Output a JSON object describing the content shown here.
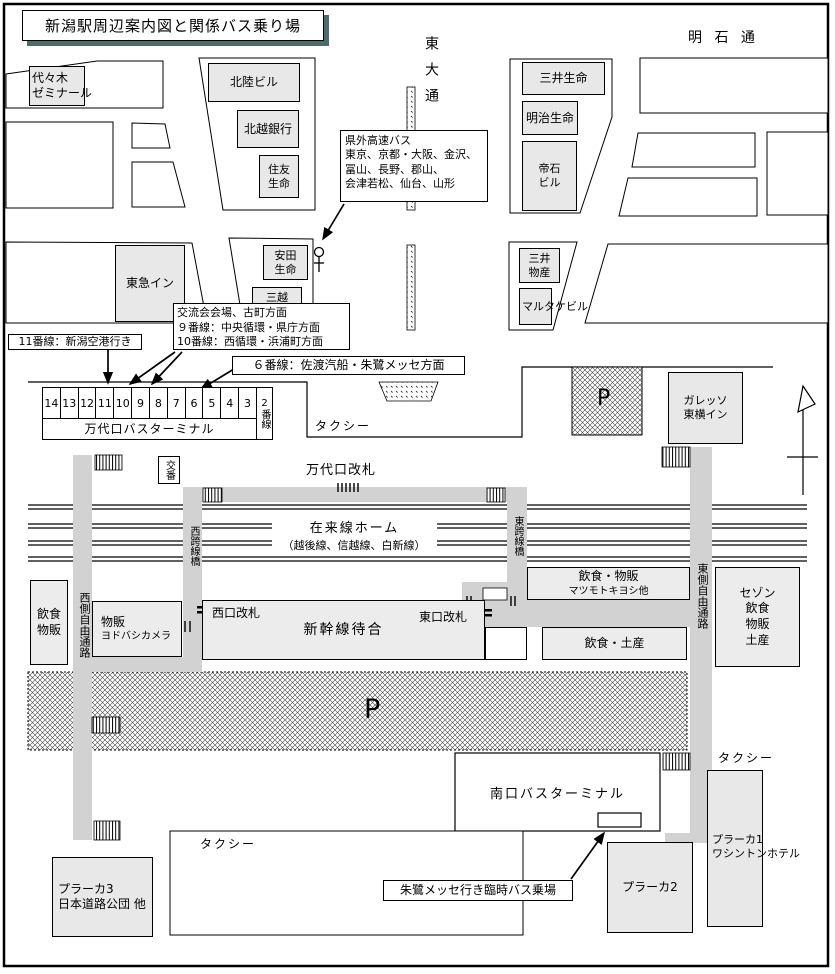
{
  "title": "新潟駅周辺案内図と関係バス乗り場",
  "streets": {
    "higashi_odori": "東大通",
    "akashi_dori": "明 石 通"
  },
  "callouts": {
    "kengai_kosoku": "県外高速バス\n東京、京都・大阪、金沢、\n冨山、長野、郡山、\n会津若松、仙台、山形",
    "kouryukai": "交流会会場、古町方面\n９番線：中央循環・県庁方面\n10番線：西循環・浜浦町方面",
    "line11": "11番線：新潟空港行き",
    "line6": "６番線：佐渡汽船・朱鷺メッセ方面",
    "toki_messe": "朱鷺メッセ行き臨時バス乗場"
  },
  "bus_terminal": {
    "name": "万代口バスターミナル",
    "stalls": [
      "14",
      "13",
      "12",
      "11",
      "10",
      "9",
      "8",
      "7",
      "6",
      "5",
      "4",
      "3"
    ],
    "last_stall": "2番線"
  },
  "buildings": {
    "yoyogi": "代々木\nゼミナール",
    "hokuriku_building": "北陸ビル",
    "hokuetsu_bank": "北越銀行",
    "sumitomo_life": "住友\n生命",
    "mitsui_life": "三井生命",
    "meiji_life": "明治生命",
    "teiseki_building": "帝石\nビル",
    "tokyu_inn": "東急イン",
    "yasuda_life": "安田\n生命",
    "mitsukoshi": "三越",
    "mitsui_bussan": "三井\n物産",
    "marutake_building": "マルタケビル",
    "galesso_toyoko_inn": "ガレッソ\n東横イン",
    "saison": "セゾン\n飲食\n物販\n土産",
    "plaka1": "プラーカ1\nワシントンホテル",
    "plaka2": "プラーカ2",
    "plaka3": "プラーカ3\n日本道路公団 他"
  },
  "station": {
    "koban": "交番",
    "bandai_gate": "万代口改札",
    "conventional_platform": "在来線ホーム",
    "conventional_lines": "（越後線、信越線、白新線）",
    "west_overpass": "西跨線橋",
    "east_overpass": "東跨線橋",
    "west_passage": "西側自由通路",
    "east_passage": "東側自由通路",
    "west_gate": "西口改札",
    "east_gate": "東口改札",
    "shinkansen_waiting": "新幹線待合",
    "yodobashi_top": "物販",
    "yodobashi_sub": "ヨドバシカメラ",
    "west_shop": "飲食\n物販",
    "matsumoto_top": "飲食・物販",
    "matsumoto_sub": "マツモトキヨシ他",
    "food_souvenir": "飲食・土産",
    "south_terminal": "南口バスターミナル"
  },
  "labels": {
    "taxi": "タクシー",
    "parking": "P"
  }
}
